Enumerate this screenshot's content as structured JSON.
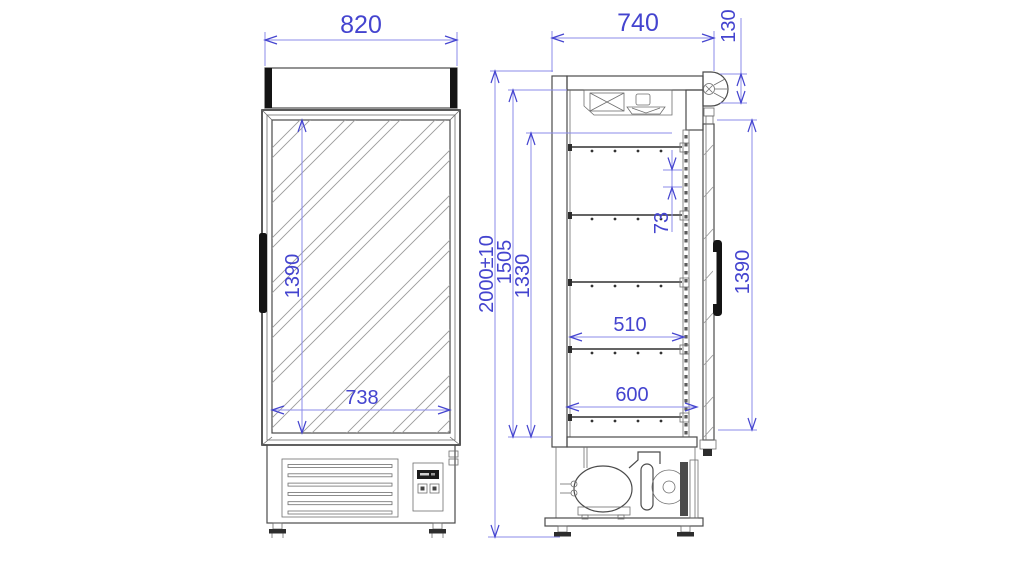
{
  "dims": {
    "front": {
      "overall_width": "820",
      "glass_height": "1390",
      "glass_width": "738"
    },
    "side": {
      "overall_depth": "740",
      "door_closer_height": "130",
      "overall_height": "2000±10",
      "interior_height": "1505",
      "clear_height": "1330",
      "shelf_pitch": "73",
      "shelf_depth": "510",
      "bottom_shelf_depth": "600",
      "door_height": "1390"
    }
  },
  "colors": {
    "dimension_text": "#4444cf",
    "dimension_line": "#8b8bea",
    "outline": "#4b4b4b",
    "dark_fill": "#141414"
  }
}
